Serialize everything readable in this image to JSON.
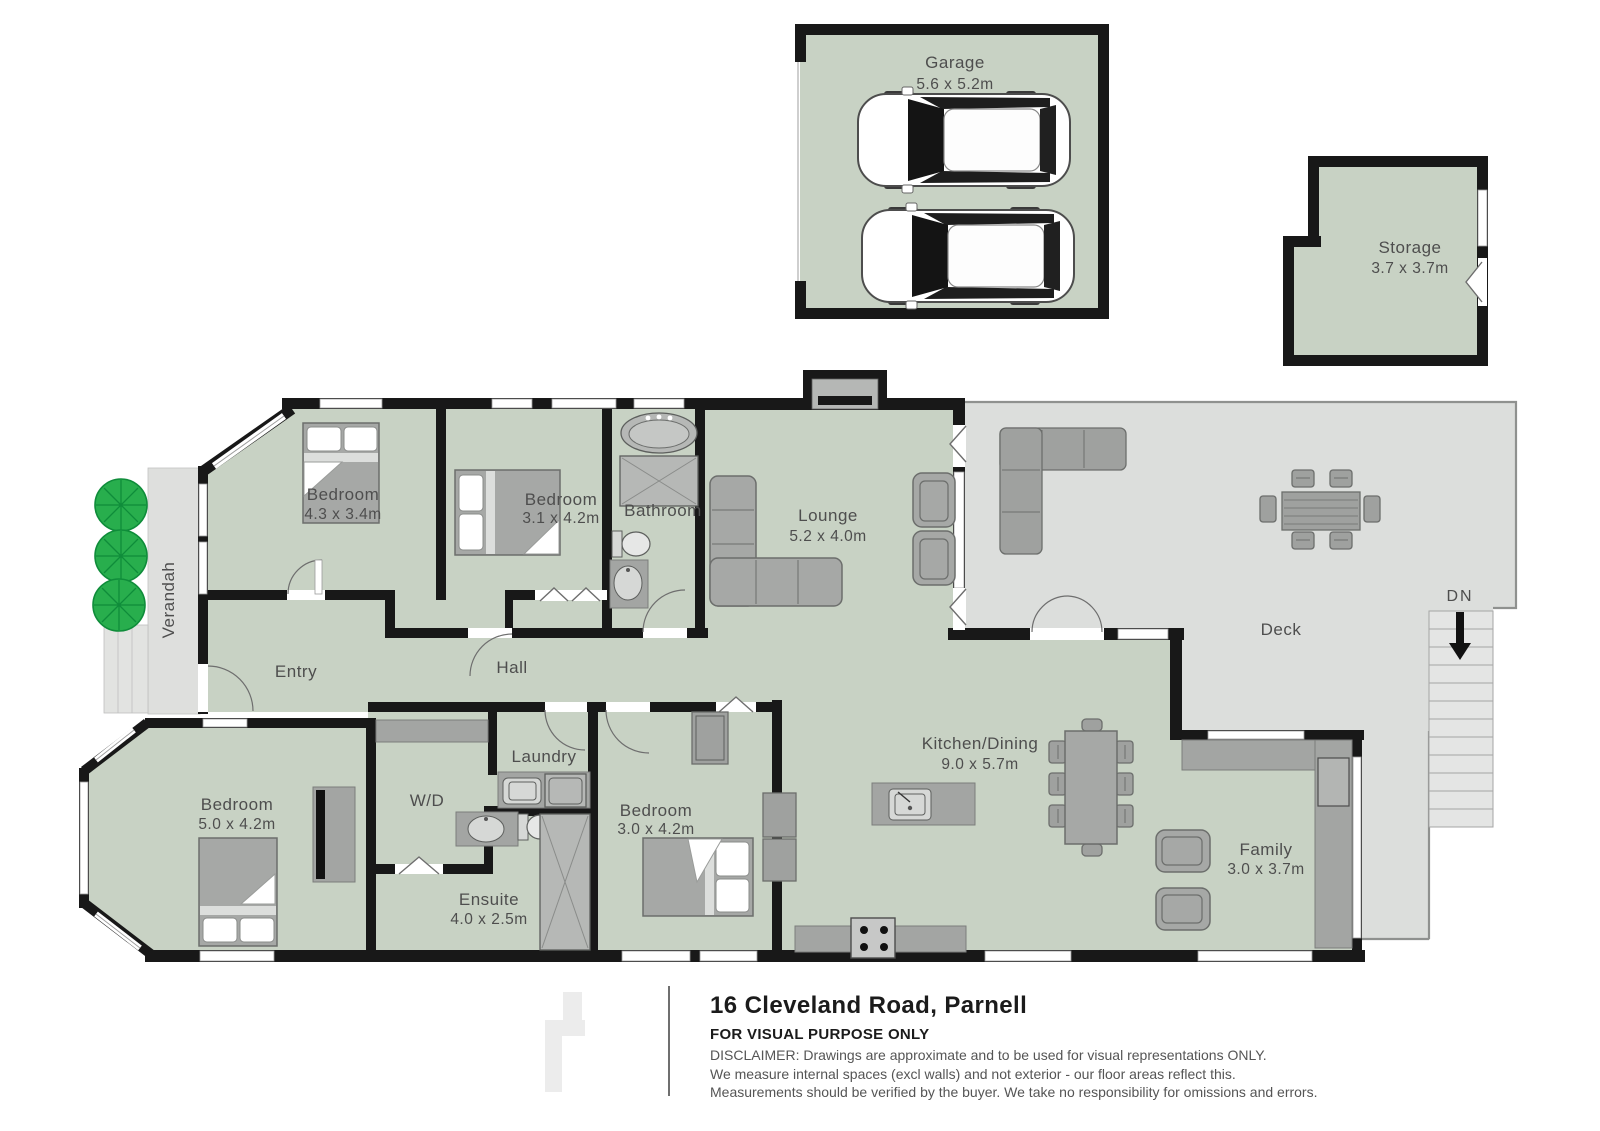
{
  "title": {
    "address": "16 Cleveland Road, Parnell",
    "purpose": "FOR VISUAL PURPOSE ONLY",
    "disclaimer_line1": "DISCLAIMER:  Drawings are approximate and to be used for visual representations ONLY.",
    "disclaimer_line2": "We measure internal spaces (excl walls) and not exterior - our floor areas reflect this.",
    "disclaimer_line3": "Measurements should be verified by the buyer. We take no responsibility for omissions and errors."
  },
  "rooms": {
    "garage": {
      "name": "Garage",
      "dims": "5.6 x 5.2m"
    },
    "storage": {
      "name": "Storage",
      "dims": "3.7 x 3.7m"
    },
    "bedroom1": {
      "name": "Bedroom",
      "dims": "4.3 x 3.4m"
    },
    "bedroom2": {
      "name": "Bedroom",
      "dims": "3.1 x 4.2m"
    },
    "bathroom": {
      "name": "Bathroom"
    },
    "lounge": {
      "name": "Lounge",
      "dims": "5.2 x 4.0m"
    },
    "entry": {
      "name": "Entry"
    },
    "hall": {
      "name": "Hall"
    },
    "verandah": {
      "name": "Verandah"
    },
    "bedroom_front": {
      "name": "Bedroom",
      "dims": "5.0 x 4.2m"
    },
    "wd": {
      "name": "W/D"
    },
    "laundry": {
      "name": "Laundry"
    },
    "ensuite": {
      "name": "Ensuite",
      "dims": "4.0 x 2.5m"
    },
    "bedroom_mid": {
      "name": "Bedroom",
      "dims": "3.0 x 4.2m"
    },
    "kitchen": {
      "name": "Kitchen/Dining",
      "dims": "9.0 x 5.7m"
    },
    "family": {
      "name": "Family",
      "dims": "3.0 x 3.7m"
    },
    "deck": {
      "name": "Deck"
    },
    "stairs": {
      "label": "DN"
    }
  },
  "colors": {
    "room_fill": "#c8d2c4",
    "deck_fill": "#dcdedc",
    "wall": "#181818",
    "tree_green": "#28ae4d",
    "furniture_gray": "#a6a8a6"
  }
}
